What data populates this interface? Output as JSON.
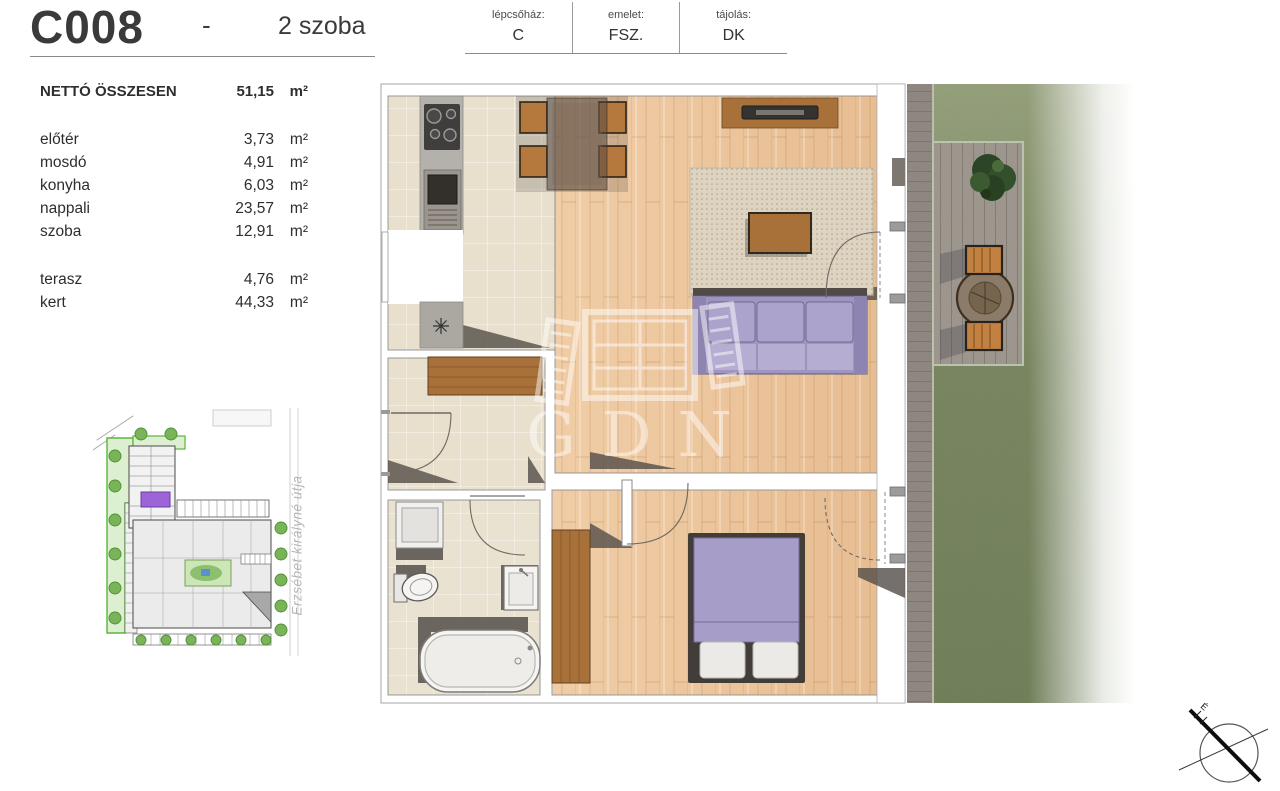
{
  "header": {
    "unit_id": "C008",
    "separator": "-",
    "unit_type": "2 szoba",
    "info": [
      {
        "label": "lépcsőház:",
        "value": "C"
      },
      {
        "label": "emelet:",
        "value": "FSZ."
      },
      {
        "label": "tájolás:",
        "value": "DK"
      }
    ]
  },
  "areas": {
    "total": {
      "label": "NETTÓ ÖSSZESEN",
      "value": "51,15",
      "unit": "m²"
    },
    "rooms": [
      {
        "label": "előtér",
        "value": "3,73",
        "unit": "m²"
      },
      {
        "label": "mosdó",
        "value": "4,91",
        "unit": "m²"
      },
      {
        "label": "konyha",
        "value": "6,03",
        "unit": "m²"
      },
      {
        "label": "nappali",
        "value": "23,57",
        "unit": "m²"
      },
      {
        "label": "szoba",
        "value": "12,91",
        "unit": "m²"
      }
    ],
    "outdoor": [
      {
        "label": "terasz",
        "value": "4,76",
        "unit": "m²"
      },
      {
        "label": "kert",
        "value": "44,33",
        "unit": "m²"
      }
    ]
  },
  "site_map": {
    "street_label": "Erzsébet királyné útja"
  },
  "floor_plan": {
    "watermark": "GDN"
  },
  "compass": {
    "north_label": "É"
  },
  "colors": {
    "wood_floor": "#ecc69e",
    "tile_floor": "#e8e0cd",
    "sofa_purple": "#9e95c1",
    "bed_purple": "#a69dc9",
    "grass": "#7c8a64",
    "paver": "#938c84",
    "patio_border": "#b9c3ae",
    "site_green": "#dcefd0",
    "site_green_border": "#5cb53c",
    "unit_highlight_purple": "#9d64d8",
    "furniture_wood": "#a9713a",
    "watermark_white": "rgba(255,255,255,0.6)"
  }
}
